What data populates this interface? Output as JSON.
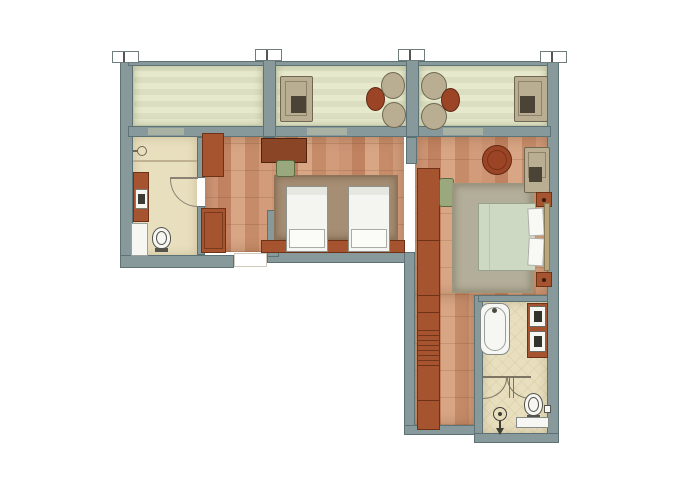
{
  "document": {
    "kind": "architectural-floor-plan",
    "title": "apartment-suite-floor-plan",
    "visible_text": []
  },
  "palette": {
    "background": "#ffffff",
    "wall": "#87999b",
    "wall_outline": "#5d7274",
    "balcony_floor": "#e7e9cd",
    "wood_floor": "#cd9574",
    "bath_floor": "#e8dfbf",
    "furniture_wood": "#a5542f",
    "furniture_wood_dark": "#8a4526",
    "table_red": "#9c4526",
    "upholstery_tan": "#b9ae92",
    "chair_green": "#9aa87e",
    "rug_twin": "#a68e74",
    "rug_master": "#b2ae99",
    "linen_white": "#f6f6f2",
    "duvet_green": "#cdd9c3",
    "fixture_line": "#54544c"
  },
  "canvas": {
    "width": 700,
    "height": 495
  },
  "elements": [
    {
      "n": "balcony-floor-left",
      "cls": "balcony",
      "x": 133,
      "y": 64,
      "w": 130,
      "h": 62
    },
    {
      "n": "balcony-floor-middle",
      "cls": "balcony",
      "x": 276,
      "y": 64,
      "w": 130,
      "h": 62
    },
    {
      "n": "balcony-floor-right",
      "cls": "balcony",
      "x": 419,
      "y": 64,
      "w": 128,
      "h": 62
    },
    {
      "n": "floor-twin-bedroom",
      "cls": "wood",
      "x": 205,
      "y": 137,
      "w": 199,
      "h": 115
    },
    {
      "n": "floor-master-bedroom",
      "cls": "wood",
      "x": 415,
      "y": 137,
      "w": 132,
      "h": 158
    },
    {
      "n": "floor-corridor",
      "cls": "wood",
      "x": 415,
      "y": 295,
      "w": 59,
      "h": 130
    },
    {
      "n": "floor-bathroom-left",
      "cls": "bath",
      "x": 133,
      "y": 137,
      "w": 64,
      "h": 118
    },
    {
      "n": "floor-bathroom-right",
      "cls": "bath bath-tile",
      "x": 483,
      "y": 302,
      "w": 64,
      "h": 131
    },
    {
      "n": "wall-exterior-left",
      "cls": "wall",
      "x": 120,
      "y": 57,
      "w": 13,
      "h": 211
    },
    {
      "n": "balcony-railing",
      "cls": "wall",
      "x": 128,
      "y": 61,
      "w": 423,
      "h": 5
    },
    {
      "n": "wall-exterior-right",
      "cls": "wall",
      "x": 547,
      "y": 57,
      "w": 12,
      "h": 386
    },
    {
      "n": "wall-window-front",
      "cls": "wall",
      "x": 128,
      "y": 126,
      "w": 423,
      "h": 11
    },
    {
      "n": "balcony-divider-left",
      "cls": "wall",
      "x": 263,
      "y": 50,
      "w": 13,
      "h": 87
    },
    {
      "n": "balcony-divider-right",
      "cls": "wall",
      "x": 406,
      "y": 50,
      "w": 13,
      "h": 87
    },
    {
      "n": "wall-exterior-bottom-left",
      "cls": "wall",
      "x": 120,
      "y": 255,
      "w": 114,
      "h": 13
    },
    {
      "n": "wall-twin-bottom",
      "cls": "wall",
      "x": 267,
      "y": 252,
      "w": 148,
      "h": 11
    },
    {
      "n": "wall-entry-partition",
      "cls": "wall",
      "x": 267,
      "y": 210,
      "w": 12,
      "h": 47
    },
    {
      "n": "wall-wing-left",
      "cls": "wall",
      "x": 404,
      "y": 252,
      "w": 11,
      "h": 183
    },
    {
      "n": "wall-corridor-bottom",
      "cls": "wall",
      "x": 404,
      "y": 425,
      "w": 74,
      "h": 10
    },
    {
      "n": "wall-bathroom-right-left",
      "cls": "wall",
      "x": 474,
      "y": 295,
      "w": 9,
      "h": 140
    },
    {
      "n": "wall-bathroom-right-bottom",
      "cls": "wall",
      "x": 474,
      "y": 433,
      "w": 85,
      "h": 10
    },
    {
      "n": "wall-bathroom-right-top",
      "cls": "wall",
      "x": 478,
      "y": 295,
      "w": 70,
      "h": 7
    },
    {
      "n": "wall-bathroom-left-upper",
      "cls": "wall",
      "x": 197,
      "y": 137,
      "w": 8,
      "h": 41
    },
    {
      "n": "wall-bathroom-left-lower",
      "cls": "wall",
      "x": 197,
      "y": 206,
      "w": 8,
      "h": 49
    },
    {
      "n": "wall-stub-twin",
      "cls": "wall",
      "x": 263,
      "y": 137,
      "w": 12,
      "h": 9
    },
    {
      "n": "wall-stub-master",
      "cls": "wall",
      "x": 406,
      "y": 137,
      "w": 11,
      "h": 27
    },
    {
      "n": "balcony-door-left",
      "x": 148,
      "y": 128,
      "w": 36,
      "h": 7,
      "bg": "#a9b2a2"
    },
    {
      "n": "balcony-door-middle",
      "x": 307,
      "y": 128,
      "w": 40,
      "h": 7,
      "bg": "#a9b2a2"
    },
    {
      "n": "balcony-door-right",
      "x": 443,
      "y": 128,
      "w": 40,
      "h": 7,
      "bg": "#a9b2a2"
    },
    {
      "n": "section-tick",
      "cls": "tick",
      "x": 112,
      "y": 51,
      "w": 27,
      "h": 12
    },
    {
      "n": "section-tick-mark",
      "x": 123,
      "y": 52,
      "w": 2,
      "h": 10,
      "bg": "#555555"
    },
    {
      "n": "section-tick",
      "cls": "tick",
      "x": 255,
      "y": 49,
      "w": 27,
      "h": 12
    },
    {
      "n": "section-tick-mark",
      "x": 266,
      "y": 50,
      "w": 2,
      "h": 10,
      "bg": "#555555"
    },
    {
      "n": "section-tick",
      "cls": "tick",
      "x": 398,
      "y": 49,
      "w": 27,
      "h": 12
    },
    {
      "n": "section-tick-mark",
      "x": 409,
      "y": 50,
      "w": 2,
      "h": 10,
      "bg": "#555555"
    },
    {
      "n": "section-tick",
      "cls": "tick",
      "x": 540,
      "y": 51,
      "w": 27,
      "h": 12
    },
    {
      "n": "section-tick-mark",
      "x": 551,
      "y": 52,
      "w": 2,
      "h": 10,
      "bg": "#555555"
    },
    {
      "n": "entry-threshold",
      "x": 234,
      "y": 253,
      "w": 33,
      "h": 14,
      "bg": "#ffffff",
      "bd": "1px solid #cfcaba"
    },
    {
      "n": "shower-divider-line",
      "x": 133,
      "y": 160,
      "w": 64,
      "h": 2,
      "bg": "#bfb190"
    },
    {
      "n": "wall-sink-icon",
      "x": 137,
      "y": 146,
      "w": 10,
      "h": 10,
      "bg": "#e8dfbf",
      "bd": "1px solid #6f6757",
      "rad": "50%"
    },
    {
      "n": "wall-sink-stem",
      "x": 133,
      "y": 150,
      "w": 5,
      "h": 2,
      "bg": "#6f6757"
    },
    {
      "n": "vanity-left",
      "x": 133,
      "y": 172,
      "w": 16,
      "h": 50,
      "bg": "#a5542f",
      "bd": "1px solid #6e3317"
    },
    {
      "n": "sink-left",
      "x": 135,
      "y": 189,
      "w": 13,
      "h": 20,
      "bg": "#f6f6f2",
      "bd": "1px solid #777e77"
    },
    {
      "n": "sink-left-basin",
      "x": 138,
      "y": 194,
      "w": 7,
      "h": 10,
      "bg": "#3c3c34"
    },
    {
      "n": "shower-tray-left",
      "x": 131,
      "y": 223,
      "w": 17,
      "h": 33,
      "bg": "#f6f6f2",
      "bd": "1px solid #9aa09e"
    },
    {
      "n": "toilet-left-bowl",
      "x": 152,
      "y": 227,
      "w": 19,
      "h": 22,
      "bg": "#f6f6f2",
      "bd": "1px solid #54544c",
      "rad": "50% 50% 45% 45%"
    },
    {
      "n": "toilet-left-seat",
      "x": 156,
      "y": 231,
      "w": 11,
      "h": 14,
      "bd": "1px solid #54544c",
      "rad": "50%"
    },
    {
      "n": "toilet-left-base",
      "x": 155,
      "y": 248,
      "w": 13,
      "h": 4,
      "bg": "#54544c"
    },
    {
      "n": "door-arc-bathroom-left",
      "x": 170,
      "y": 179,
      "w": 28,
      "h": 28,
      "rad": "0 0 0 100%",
      "sides": {
        "l": "1px solid #8b8174",
        "b": "1px solid #8b8174"
      }
    },
    {
      "n": "door-leaf-bathroom-left",
      "x": 170,
      "y": 177,
      "w": 28,
      "h": 2,
      "bg": "#8b8174"
    },
    {
      "n": "luggage-rack",
      "cls": "slats",
      "x": 202,
      "y": 133,
      "w": 22,
      "h": 44,
      "bg": "#a5542f",
      "bd": "1px solid #6e3317"
    },
    {
      "n": "entry-wardrobe",
      "x": 201,
      "y": 208,
      "w": 25,
      "h": 45,
      "bg": "#a5542f",
      "bd": "1px solid #6e3317"
    },
    {
      "n": "entry-wardrobe-frame",
      "x": 204,
      "y": 212,
      "w": 19,
      "h": 37,
      "bd": "1px solid #7c3a1c"
    },
    {
      "n": "rug-twin",
      "cls": "rug",
      "x": 274,
      "y": 175,
      "w": 124,
      "h": 65,
      "bg": "#a68e74",
      "bd": "2px solid #8d7459"
    },
    {
      "n": "desk-twin",
      "x": 261,
      "y": 138,
      "w": 46,
      "h": 25,
      "bg": "#8a4526",
      "bd": "1px solid #4f2310"
    },
    {
      "n": "desk-chair-twin",
      "x": 276,
      "y": 160,
      "w": 19,
      "h": 17,
      "bg": "#9aa87e",
      "bd": "1px solid #5c6b42",
      "rad": "3px"
    },
    {
      "n": "twin-headboard",
      "x": 261,
      "y": 240,
      "w": 144,
      "h": 13,
      "bg": "#a5542f",
      "bd": "1px solid #6e3317"
    },
    {
      "n": "twin-bed-1",
      "x": 286,
      "y": 186,
      "w": 42,
      "h": 66,
      "bg": "#f4f4f0",
      "bd": "1px solid #8e938d"
    },
    {
      "n": "twin-bed-1-sheet",
      "x": 287,
      "y": 187,
      "w": 40,
      "h": 8,
      "bg": "#e7e7e1"
    },
    {
      "n": "twin-bed-1-pillow",
      "x": 289,
      "y": 229,
      "w": 36,
      "h": 19,
      "bg": "#fbfbf8",
      "bd": "1px solid #a9aca4"
    },
    {
      "n": "twin-bed-2",
      "x": 348,
      "y": 186,
      "w": 42,
      "h": 66,
      "bg": "#f4f4f0",
      "bd": "1px solid #8e938d"
    },
    {
      "n": "twin-bed-2-sheet",
      "x": 349,
      "y": 187,
      "w": 40,
      "h": 8,
      "bg": "#e7e7e1"
    },
    {
      "n": "twin-bed-2-pillow",
      "x": 351,
      "y": 229,
      "w": 36,
      "h": 19,
      "bg": "#fbfbf8",
      "bd": "1px solid #a9aca4"
    },
    {
      "n": "closet-long",
      "x": 417,
      "y": 168,
      "w": 23,
      "h": 262,
      "bg": "#a5542f",
      "bd": "1px solid #6e3317"
    },
    {
      "n": "closet-hatch",
      "cls": "slats",
      "x": 418,
      "y": 330,
      "w": 21,
      "h": 35
    },
    {
      "n": "closet-line",
      "x": 417,
      "y": 240,
      "w": 23,
      "h": 1,
      "bg": "#6e3317"
    },
    {
      "n": "closet-line",
      "x": 417,
      "y": 295,
      "w": 23,
      "h": 1,
      "bg": "#6e3317"
    },
    {
      "n": "closet-line",
      "x": 417,
      "y": 312,
      "w": 23,
      "h": 1,
      "bg": "#6e3317"
    },
    {
      "n": "closet-line",
      "x": 417,
      "y": 365,
      "w": 23,
      "h": 1,
      "bg": "#6e3317"
    },
    {
      "n": "closet-line",
      "x": 417,
      "y": 400,
      "w": 23,
      "h": 1,
      "bg": "#6e3317"
    },
    {
      "n": "desk-chair-master",
      "x": 439,
      "y": 178,
      "w": 15,
      "h": 29,
      "bg": "#9aa87e",
      "bd": "1px solid #5c6b42",
      "rad": "3px"
    },
    {
      "n": "rug-master",
      "cls": "rug",
      "x": 452,
      "y": 183,
      "w": 81,
      "h": 110,
      "bg": "#b2ae99",
      "bd": "2px solid #9b977f"
    },
    {
      "n": "side-table-master",
      "x": 482,
      "y": 145,
      "w": 30,
      "h": 30,
      "bg": "#9c4526",
      "bd": "1px solid #5f2814",
      "rad": "50%"
    },
    {
      "n": "side-table-master-ring",
      "x": 487,
      "y": 150,
      "w": 20,
      "h": 20,
      "bd": "1px solid #7c3018",
      "rad": "50%"
    },
    {
      "n": "armchair-master",
      "x": 524,
      "y": 147,
      "w": 26,
      "h": 46,
      "bg": "#b9ae92",
      "bd": "1px solid #6f6752",
      "rad": "2px"
    },
    {
      "n": "armchair-master-cushion",
      "x": 528,
      "y": 152,
      "w": 18,
      "h": 26,
      "bd": "1px solid #8d856b"
    },
    {
      "n": "armchair-master-seat",
      "x": 529,
      "y": 167,
      "w": 13,
      "h": 15,
      "bg": "#4a4336"
    },
    {
      "n": "nightstand-top",
      "x": 536,
      "y": 192,
      "w": 16,
      "h": 15,
      "bg": "#a5542f",
      "bd": "1px solid #6e3317"
    },
    {
      "n": "nightstand-top-knob",
      "x": 542,
      "y": 198,
      "w": 4,
      "h": 4,
      "bg": "#3a1c0e",
      "rad": "50%"
    },
    {
      "n": "master-bed-duvet",
      "x": 478,
      "y": 203,
      "w": 58,
      "h": 68,
      "bg": "#cdd9c3",
      "bd": "1px solid #96a28c"
    },
    {
      "n": "master-bed-fold",
      "x": 489,
      "y": 204,
      "w": 1,
      "h": 66,
      "bg": "#b9c6af"
    },
    {
      "n": "master-pillow-1",
      "x": 528,
      "y": 208,
      "w": 16,
      "h": 28,
      "bg": "#f8f8f4",
      "bd": "1px solid #a9aca4",
      "rot": -3
    },
    {
      "n": "master-pillow-2",
      "x": 528,
      "y": 238,
      "w": 16,
      "h": 28,
      "bg": "#f8f8f4",
      "bd": "1px solid #a9aca4",
      "rot": 3
    },
    {
      "n": "master-headboard",
      "x": 544,
      "y": 203,
      "w": 6,
      "h": 68,
      "bg": "#b9a87e",
      "bd": "1px solid #8a7a55"
    },
    {
      "n": "nightstand-bottom",
      "x": 536,
      "y": 272,
      "w": 16,
      "h": 15,
      "bg": "#a5542f",
      "bd": "1px solid #6e3317"
    },
    {
      "n": "nightstand-bottom-knob",
      "x": 542,
      "y": 278,
      "w": 4,
      "h": 4,
      "bg": "#3a1c0e",
      "rad": "50%"
    },
    {
      "n": "balcony-armchair-middle",
      "x": 280,
      "y": 76,
      "w": 33,
      "h": 46,
      "bg": "#b9ae92",
      "bd": "1px solid #6f6752",
      "rad": "2px"
    },
    {
      "n": "balcony-armchair-middle-cushion",
      "x": 285,
      "y": 81,
      "w": 22,
      "h": 35,
      "bd": "1px solid #8d856b"
    },
    {
      "n": "balcony-armchair-middle-seat",
      "x": 291,
      "y": 96,
      "w": 15,
      "h": 17,
      "bg": "#4a4336"
    },
    {
      "n": "balcony-table-middle",
      "x": 366,
      "y": 87,
      "w": 19,
      "h": 24,
      "bg": "#9c4526",
      "bd": "1px solid #5f2814",
      "rad": "50%"
    },
    {
      "n": "balcony-chair",
      "x": 381,
      "y": 72,
      "w": 24,
      "h": 27,
      "bg": "#b9ae92",
      "bd": "1px solid #6f6752",
      "rad": "50%"
    },
    {
      "n": "balcony-chair",
      "x": 382,
      "y": 102,
      "w": 24,
      "h": 26,
      "bg": "#b9ae92",
      "bd": "1px solid #6f6752",
      "rad": "50%"
    },
    {
      "n": "balcony-chair",
      "x": 421,
      "y": 72,
      "w": 26,
      "h": 28,
      "bg": "#b9ae92",
      "bd": "1px solid #6f6752",
      "rad": "50%"
    },
    {
      "n": "balcony-chair",
      "x": 421,
      "y": 103,
      "w": 26,
      "h": 27,
      "bg": "#b9ae92",
      "bd": "1px solid #6f6752",
      "rad": "50%"
    },
    {
      "n": "balcony-table-right",
      "x": 441,
      "y": 88,
      "w": 19,
      "h": 24,
      "bg": "#9c4526",
      "bd": "1px solid #5f2814",
      "rad": "50%"
    },
    {
      "n": "balcony-armchair-right",
      "x": 514,
      "y": 76,
      "w": 34,
      "h": 46,
      "bg": "#b9ae92",
      "bd": "1px solid #6f6752",
      "rad": "2px"
    },
    {
      "n": "balcony-armchair-right-cushion",
      "x": 518,
      "y": 81,
      "w": 24,
      "h": 35,
      "bd": "1px solid #8d856b"
    },
    {
      "n": "balcony-armchair-right-seat",
      "x": 520,
      "y": 96,
      "w": 15,
      "h": 17,
      "bg": "#4a4336"
    },
    {
      "n": "bathtub",
      "x": 480,
      "y": 303,
      "w": 30,
      "h": 52,
      "bg": "#f6f6f2",
      "bd": "1px solid #84898a",
      "rad": "9px"
    },
    {
      "n": "bathtub-basin",
      "x": 484,
      "y": 307,
      "w": 22,
      "h": 44,
      "bd": "1px solid #9a9f9e",
      "rad": "11px"
    },
    {
      "n": "bathtub-faucet",
      "x": 492,
      "y": 308,
      "w": 5,
      "h": 5,
      "bg": "#4a4a42",
      "rad": "50%"
    },
    {
      "n": "vanity-right",
      "x": 527,
      "y": 303,
      "w": 21,
      "h": 55,
      "bg": "#a5542f",
      "bd": "1px solid #6e3317"
    },
    {
      "n": "sink-right-1",
      "x": 529,
      "y": 306,
      "w": 17,
      "h": 21,
      "bg": "#f6f6f2",
      "bd": "1px solid #6b6b63"
    },
    {
      "n": "sink-right-1-basin",
      "x": 534,
      "y": 311,
      "w": 8,
      "h": 11,
      "bg": "#33332c"
    },
    {
      "n": "sink-right-2",
      "x": 529,
      "y": 331,
      "w": 17,
      "h": 21,
      "bg": "#f6f6f2",
      "bd": "1px solid #6b6b63"
    },
    {
      "n": "sink-right-2-basin",
      "x": 534,
      "y": 336,
      "w": 8,
      "h": 11,
      "bg": "#33332c"
    },
    {
      "n": "shower-partition-line",
      "x": 483,
      "y": 376,
      "w": 48,
      "h": 2,
      "bg": "#7d7463"
    },
    {
      "n": "shower-door-arc-1",
      "x": 483,
      "y": 378,
      "w": 24,
      "h": 21,
      "rad": "0 0 100% 0",
      "sides": {
        "r": "1px solid #7d7463",
        "b": "1px solid #7d7463"
      }
    },
    {
      "n": "shower-door-arc-2",
      "x": 507,
      "y": 378,
      "w": 24,
      "h": 21,
      "rad": "0 0 0 100%",
      "sides": {
        "l": "1px solid #7d7463",
        "b": "1px solid #7d7463"
      }
    },
    {
      "n": "shower-door-hinge",
      "x": 509,
      "y": 378,
      "w": 1,
      "h": 20,
      "bg": "#7d7463"
    },
    {
      "n": "shower-door-hinge",
      "x": 513,
      "y": 378,
      "w": 1,
      "h": 20,
      "bg": "#7d7463"
    },
    {
      "n": "toilet-right-bowl",
      "x": 524,
      "y": 393,
      "w": 19,
      "h": 23,
      "bg": "#f6f6f2",
      "bd": "1px solid #54544c",
      "rad": "50% 50% 46% 46%"
    },
    {
      "n": "toilet-right-seat",
      "x": 528,
      "y": 397,
      "w": 11,
      "h": 15,
      "bd": "1px solid #54544c",
      "rad": "50%"
    },
    {
      "n": "toilet-right-base",
      "x": 527,
      "y": 415,
      "w": 13,
      "h": 4,
      "bg": "#54544c"
    },
    {
      "n": "wall-niche",
      "x": 544,
      "y": 405,
      "w": 7,
      "h": 8,
      "bg": "#f6f6f2",
      "bd": "1px solid #54544c"
    },
    {
      "n": "shower-head-icon",
      "x": 493,
      "y": 407,
      "w": 14,
      "h": 14,
      "bd": "1px solid #3e3e36",
      "rad": "50%"
    },
    {
      "n": "shower-head-dot",
      "x": 498,
      "y": 412,
      "w": 4,
      "h": 4,
      "bg": "#3e3e36",
      "rad": "50%"
    },
    {
      "n": "shower-drain-stem",
      "x": 499,
      "y": 421,
      "w": 2,
      "h": 8,
      "bg": "#3e3e36"
    },
    {
      "n": "shower-drain-arrow",
      "cls": "tri-down",
      "x": 496,
      "y": 428,
      "w": 0,
      "h": 0
    },
    {
      "n": "bath-bench",
      "x": 516,
      "y": 417,
      "w": 33,
      "h": 11,
      "bg": "#f6f6f2",
      "bd": "1px solid #84898a"
    }
  ]
}
